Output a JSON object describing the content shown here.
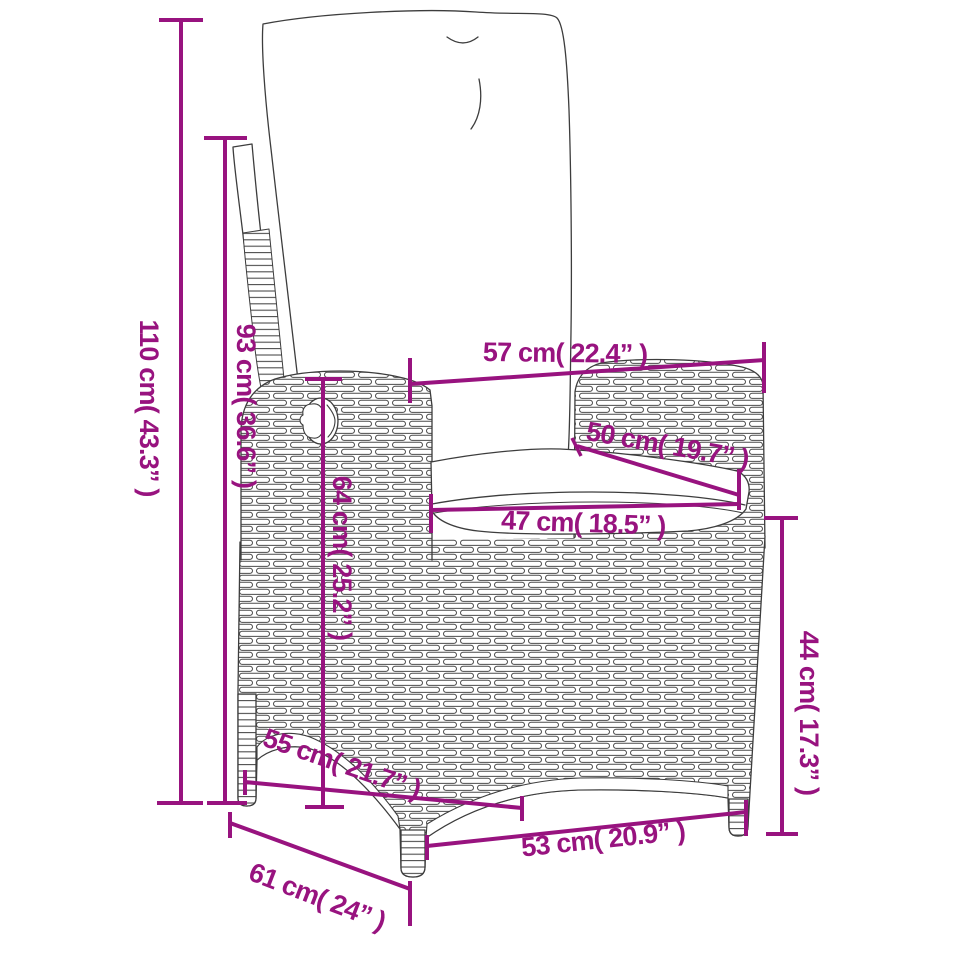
{
  "page": {
    "type": "product dimension diagram",
    "subject": "reclining poly-rattan garden chair with cushions",
    "background": "#FFFFFF"
  },
  "style": {
    "dimension_color": "#98137F",
    "outline_color": "#3D3D3D",
    "fill_color": "#FFFFFF"
  },
  "dimensions": [
    {
      "id": "overall-height",
      "label": "110 cm( 43.3” )",
      "value_cm": 110,
      "value_in": 43.3,
      "orientation": "vertical"
    },
    {
      "id": "backrest-height",
      "label": "93 cm( 36.6” )",
      "value_cm": 93,
      "value_in": 36.6,
      "orientation": "vertical"
    },
    {
      "id": "armrest-height",
      "label": "64 cm( 25.2” )",
      "value_cm": 64,
      "value_in": 25.2,
      "orientation": "vertical"
    },
    {
      "id": "back-top-width",
      "label": "57 cm( 22.4” )",
      "value_cm": 57,
      "value_in": 22.4,
      "orientation": "horizontal"
    },
    {
      "id": "armrest-length",
      "label": "50 cm( 19.7” )",
      "value_cm": 50,
      "value_in": 19.7,
      "orientation": "diagonal"
    },
    {
      "id": "seat-width",
      "label": "47 cm( 18.5” )",
      "value_cm": 47,
      "value_in": 18.5,
      "orientation": "horizontal"
    },
    {
      "id": "seat-height",
      "label": "44 cm( 17.3” )",
      "value_cm": 44,
      "value_in": 17.3,
      "orientation": "vertical"
    },
    {
      "id": "seat-depth",
      "label": "55 cm( 21.7” )",
      "value_cm": 55,
      "value_in": 21.7,
      "orientation": "diagonal"
    },
    {
      "id": "base-depth",
      "label": "61 cm( 24” )",
      "value_cm": 61,
      "value_in": 24,
      "orientation": "diagonal"
    },
    {
      "id": "front-width",
      "label": "53 cm( 20.9” )",
      "value_cm": 53,
      "value_in": 20.9,
      "orientation": "horizontal"
    }
  ]
}
